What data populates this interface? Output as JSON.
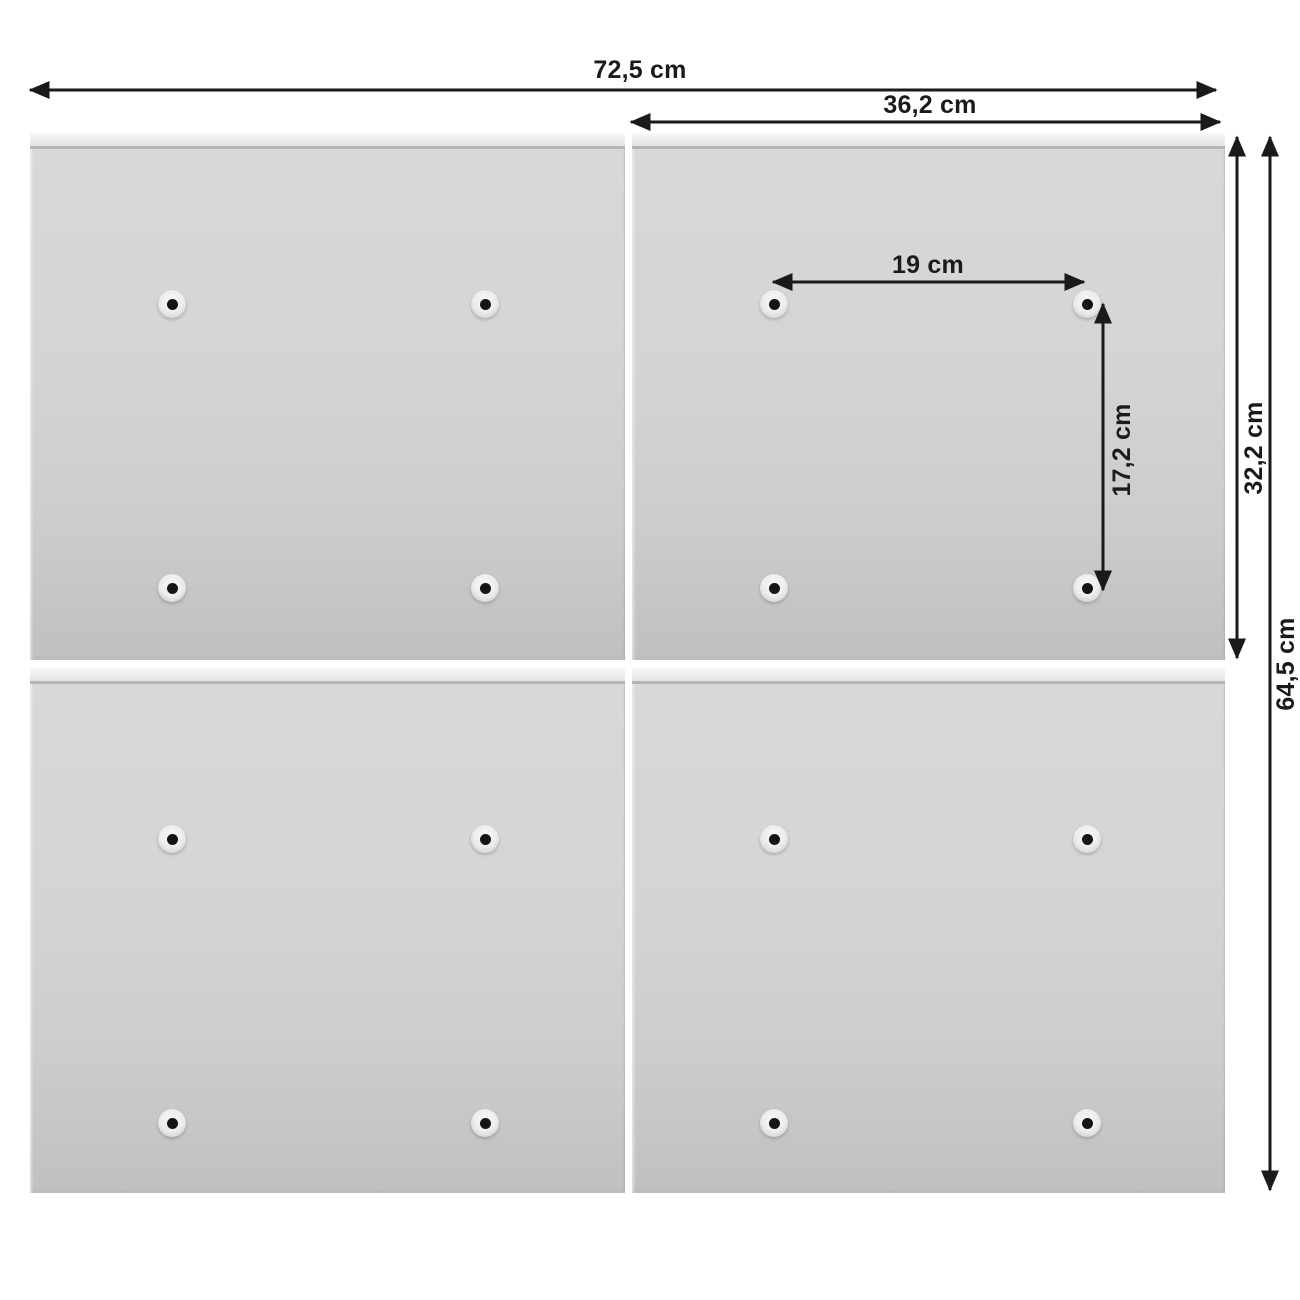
{
  "diagram": {
    "kind": "product-dimension-diagram",
    "dimensions": {
      "total_width": "72,5 cm",
      "panel_width": "36,2 cm",
      "hole_spacing_horizontal": "19 cm",
      "hole_spacing_vertical": "17,2 cm",
      "panel_height": "32,2 cm",
      "total_height": "64,5 cm"
    },
    "layout": {
      "panel_rows": 2,
      "panel_columns": 2,
      "holes_per_panel": 4
    },
    "colors": {
      "background": "#ffffff",
      "dimension_line": "#1a1a1a",
      "label_text": "#1b1b1b",
      "panel_body_light": "#d7d8d9",
      "panel_body_dark": "#bfc0c2",
      "panel_rail": "#eceded",
      "rail_shadow_line": "#b3b5b7",
      "hole_dimple": "#ecedee",
      "hole_dot": "#151515"
    }
  }
}
